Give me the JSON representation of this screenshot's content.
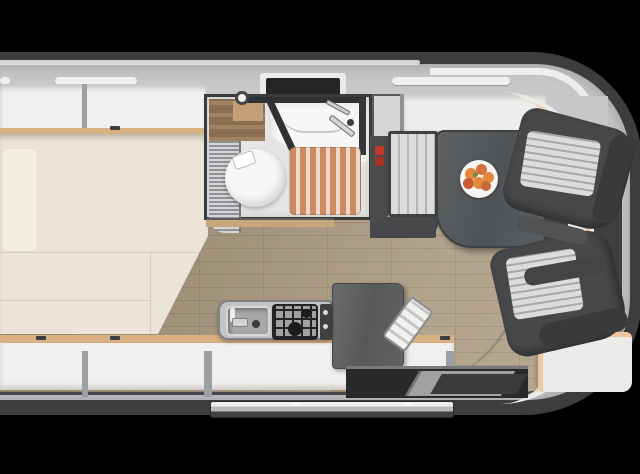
{
  "scene": {
    "view": "top-down caravan interior floor plan render",
    "regions": {
      "body": "caravan-body",
      "bed": "double-bed",
      "top_shelf": "overhead-locker-row-top",
      "bottom_shelf": "overhead-locker-row-bottom",
      "bathroom": "washroom",
      "toilet": "toilet",
      "shower_tray": "shower-and-basin",
      "slat_mat": "wooden-shower-mat",
      "wardrobe": "wardrobe-unit",
      "bench": "dinette-bench",
      "overhead_locker": "dinette-overhead-locker",
      "table": "dinette-table",
      "plate": "fruit-plate",
      "seat1": "lounge-seat-upper",
      "seat2": "lounge-seat-lower",
      "sideboard": "front-sideboard-with-trim",
      "bottom_cabinet": "front-corner-cabinet",
      "kitchen": "kitchen-unit",
      "sink": "kitchen-sink",
      "hob": "two-burner-hob",
      "dark_counter": "kitchen-worktop",
      "step_item": "folding-step",
      "doorway": "entry-door-recess",
      "step_bar": "entry-step-bar",
      "windows": "roof-window-strips",
      "skylight": "bathroom-skylight",
      "floor": "wood-plank-floor"
    },
    "counts": {
      "window_strips": 3,
      "lounge_seats": 2,
      "fruits_on_plate": 6
    }
  },
  "colors": {
    "bg": "#000000",
    "body_outline": "#3c3d3f",
    "wall_band": "#c7c8ca",
    "shelf_white": "#f1f0ee",
    "wood_trim": "#d9b082",
    "bed_cream": "#ece5d7",
    "floor_dark": "#8c7963",
    "floor_mid": "#9f9078",
    "floor_light": "#b2a38d",
    "bath_floor": "#e6e5e3",
    "bath_wood": "#8a6e51",
    "fixture_white": "#f7f7f7",
    "slat_orange": "#cd8a5e",
    "slat_gap": "#ead9c8",
    "counter_gray": "#c3c4c6",
    "counter_dark": "#56585a",
    "grate_black": "#232425",
    "table_gray": "#505355",
    "seat_dark": "#47484a",
    "cushion_light": "#dcdcda",
    "cushion_stripe": "#b4b4b2",
    "peach_trim": "#f0c79e",
    "red_switch": "#c0392b",
    "fruit_orange": "#e2873d",
    "fruit_red": "#cc5b35",
    "door_dark": "#28292b",
    "step_silver": "#b9babc"
  }
}
